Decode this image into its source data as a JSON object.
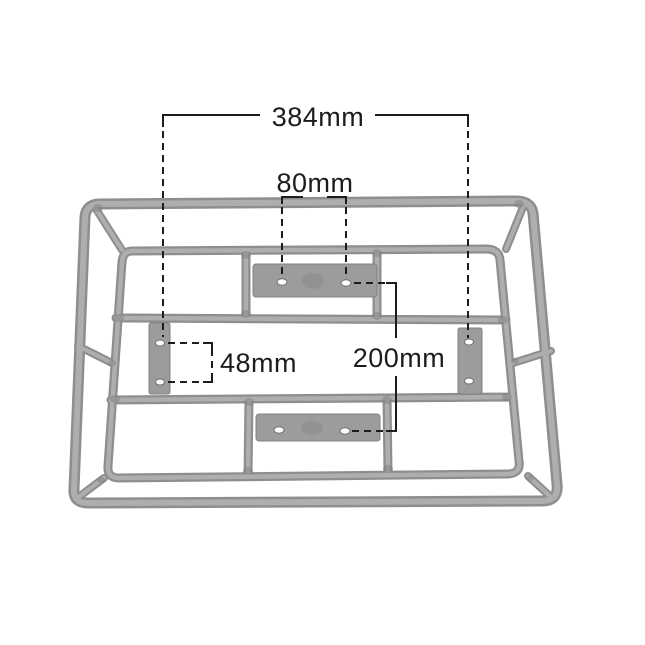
{
  "canvas": {
    "width": 645,
    "height": 645,
    "background": "#ffffff"
  },
  "diagram": {
    "kind": "technical-dimension-drawing",
    "colors": {
      "frame_tube": "#adadad",
      "frame_tube_edge": "#8e8e8e",
      "mounting_plate": "#9c9c9c",
      "plate_hole": "#ffffff",
      "annotation": "#1d1d1d",
      "background": "#ffffff"
    },
    "dimensions": [
      {
        "id": "dim-384",
        "label": "384mm",
        "orientation": "horizontal"
      },
      {
        "id": "dim-80",
        "label": "80mm",
        "orientation": "horizontal"
      },
      {
        "id": "dim-48",
        "label": "48mm",
        "orientation": "vertical"
      },
      {
        "id": "dim-200",
        "label": "200mm",
        "orientation": "vertical"
      }
    ]
  }
}
